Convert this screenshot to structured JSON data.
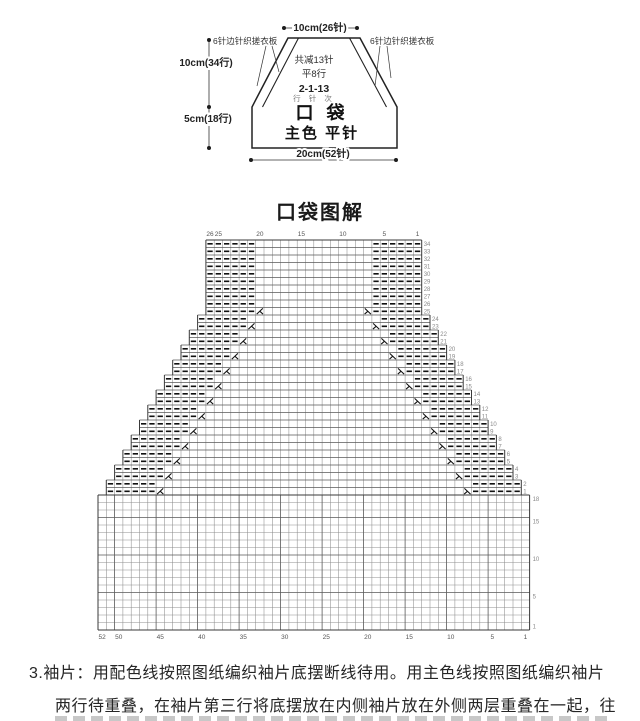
{
  "schematic": {
    "top_width": "10cm(26针)",
    "side_upper": "10cm(34行)",
    "side_lower": "5cm(18行)",
    "bottom_width": "20cm(52针)",
    "border_note_left": "6针边针织搓衣板",
    "border_note_right": "6针边针织搓衣板",
    "dec_total": "共减13针",
    "plain_rows": "平8行",
    "dec_formula": "2-1-13",
    "dec_legend": "行 针 次",
    "piece_name": "口 袋",
    "piece_stitch": "主色 平针"
  },
  "chart_title": "口袋图解",
  "chart_data": {
    "type": "knitting-chart",
    "title": "口袋图解",
    "upper_section": {
      "rows": 34,
      "top_cols": 26,
      "bottom_cols": 50,
      "border_stitches_each_side": 6,
      "border_symbol": "purl-dash",
      "step_rows": 2,
      "decrease_rows": [
        1,
        3,
        5,
        7,
        9,
        11,
        13,
        15,
        17,
        19,
        21,
        23,
        25
      ],
      "plain_top_rows": 8,
      "top_col_labels": [
        26,
        25,
        20,
        15,
        10,
        5,
        1
      ],
      "right_row_labels": "every row 1-34"
    },
    "lower_section": {
      "rows": 18,
      "cols": 52,
      "stitch": "plain",
      "right_row_labels": [
        18,
        15,
        10,
        5,
        1
      ],
      "bottom_col_labels": [
        52,
        50,
        45,
        40,
        35,
        30,
        25,
        20,
        15,
        10,
        5,
        1
      ]
    },
    "symbols": {
      "purl": "—",
      "decrease_left": "⋋",
      "decrease_right": "⋌"
    },
    "colors": {
      "grid": "#8f8f8f",
      "edge": "#3a3a3a",
      "symbol": "#111111",
      "label": "#8a8a8a"
    }
  },
  "footer": {
    "line1": "3.袖片：用配色线按照图纸编织袖片底摆断线待用。用主色线按照图纸编织袖片",
    "line2": "两行待重叠，在袖片第三行将底摆放在内侧袖片放在外侧两层重叠在一起，往"
  }
}
